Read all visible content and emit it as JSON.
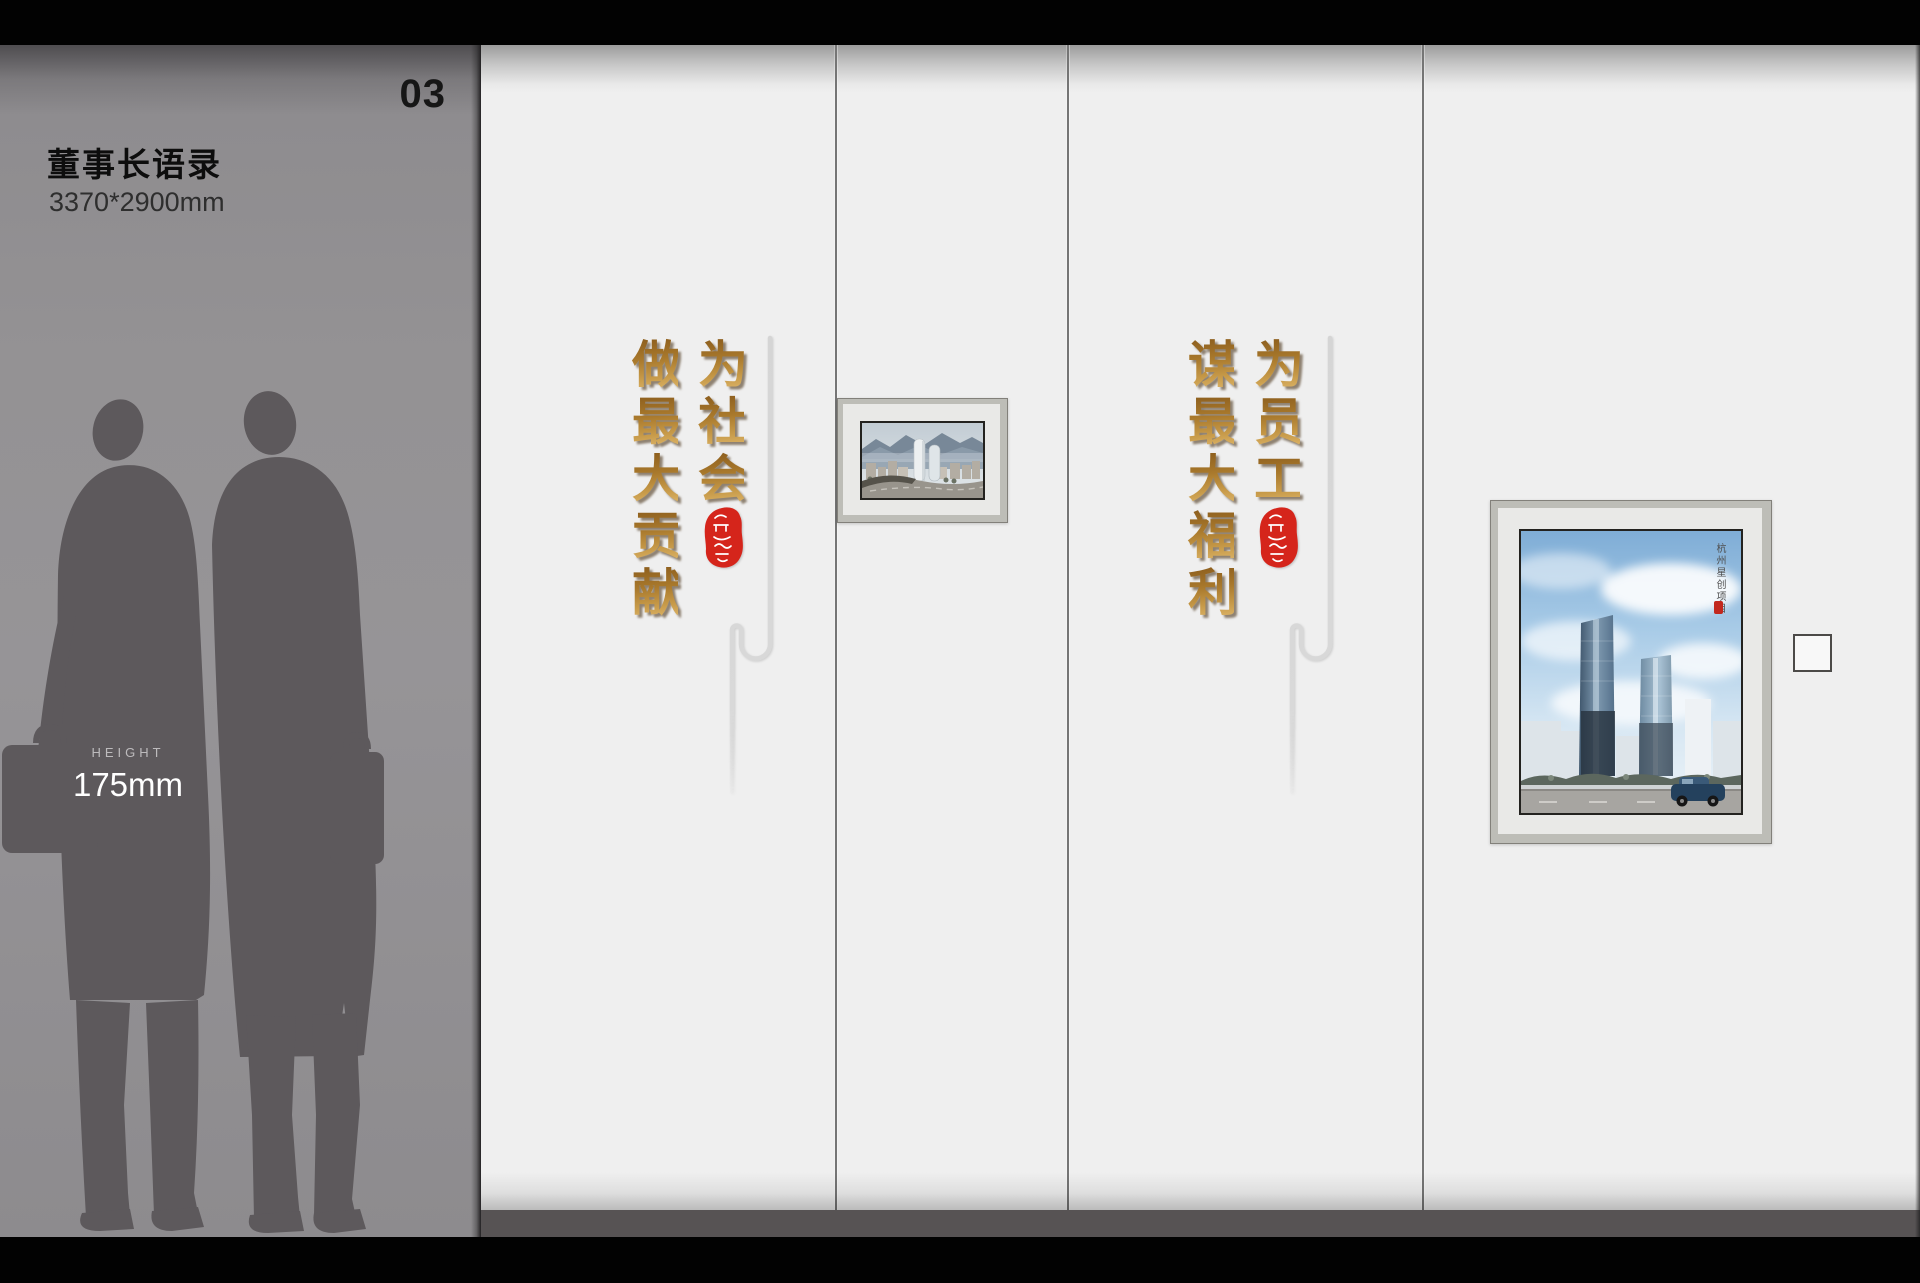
{
  "header": {
    "index_number": "03"
  },
  "sidebar": {
    "title": "董事长语录",
    "size_spec": "3370*2900mm",
    "height_label": "HEIGHT",
    "height_value": "175mm"
  },
  "quotes": {
    "society_panel": {
      "primary": "为社会",
      "secondary": "做最大贡献",
      "full_text": "为社会做最大贡献"
    },
    "staff_panel": {
      "primary": "为员工",
      "secondary": "谋最大福利",
      "full_text": "为员工谋最大福利"
    }
  },
  "poster": {
    "caption": "杭州星创项目"
  },
  "colors": {
    "gold_dark": "#8a5c1d",
    "gold_light": "#e0b96e",
    "seal_red": "#d5251b",
    "wall_white": "#efefef",
    "sidebar_gray": "#949294",
    "silhouette": "#5d595c",
    "floor_strip": "#575354",
    "top_bar": "#020202"
  }
}
